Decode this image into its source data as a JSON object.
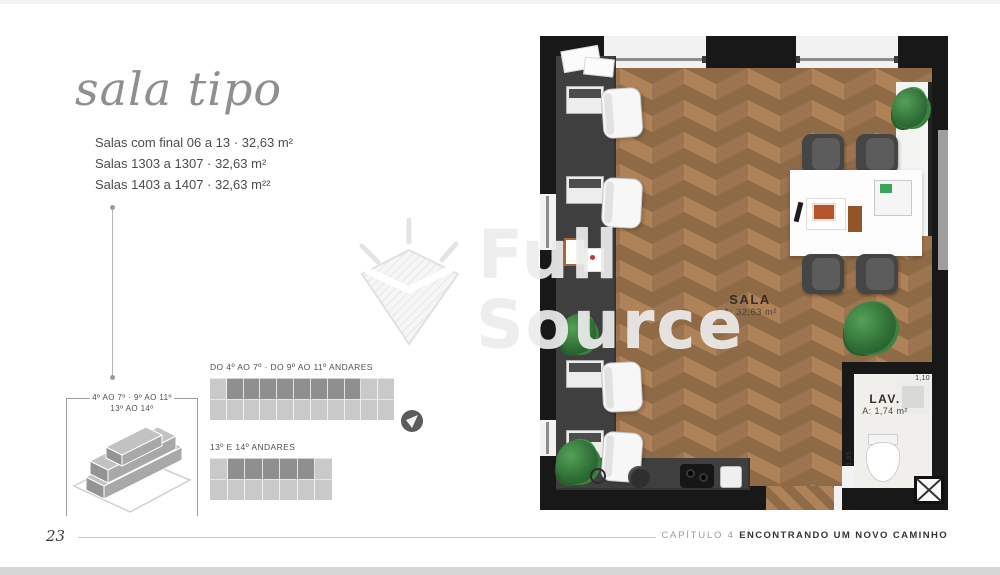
{
  "header": {
    "title": "sala tipo"
  },
  "specs": {
    "lines": [
      "Salas com final 06 a 13 · 32,63 m²",
      "Salas 1303 a 1307 · 32,63 m²",
      "Salas 1403 a 1407 · 32,63 m²²"
    ]
  },
  "building_key": {
    "line1": "4º AO 7º · 9º AO 11º",
    "line2": "13º AO 14º"
  },
  "floor_diagrams": [
    {
      "label": "DO 4º AO 7º · DO 9º AO 11º ANDARES",
      "top_cells": 11,
      "bottom_cells": 11,
      "highlight_from": 2,
      "highlight_to": 9
    },
    {
      "label": "13º E 14º ANDARES",
      "top_cells": 7,
      "bottom_cells": 7,
      "highlight_from": 2,
      "highlight_to": 6
    }
  ],
  "floorplan": {
    "sala_name": "SALA",
    "sala_area": "A: 32,63 m²",
    "lav_name": "LAV.",
    "lav_area": "A: 1,74 m²",
    "dim_top": "1,10",
    "dim_side": "1,65"
  },
  "watermark": {
    "line1": "Full",
    "line2": "Source"
  },
  "footer": {
    "page_number": "23",
    "chapter_label": "CAPÍTULO 4",
    "chapter_title": "ENCONTRANDO UM NOVO CAMINHO"
  },
  "colors": {
    "wall": "#181818",
    "wood_base": "#8f6a47",
    "wood_light": "#b08257",
    "wood_mid": "#9d7450",
    "counter": "#3f3f3f",
    "diagram_light": "#c9c9c9",
    "diagram_dark": "#8f8f8f",
    "title_gray": "#8f8f8f"
  }
}
